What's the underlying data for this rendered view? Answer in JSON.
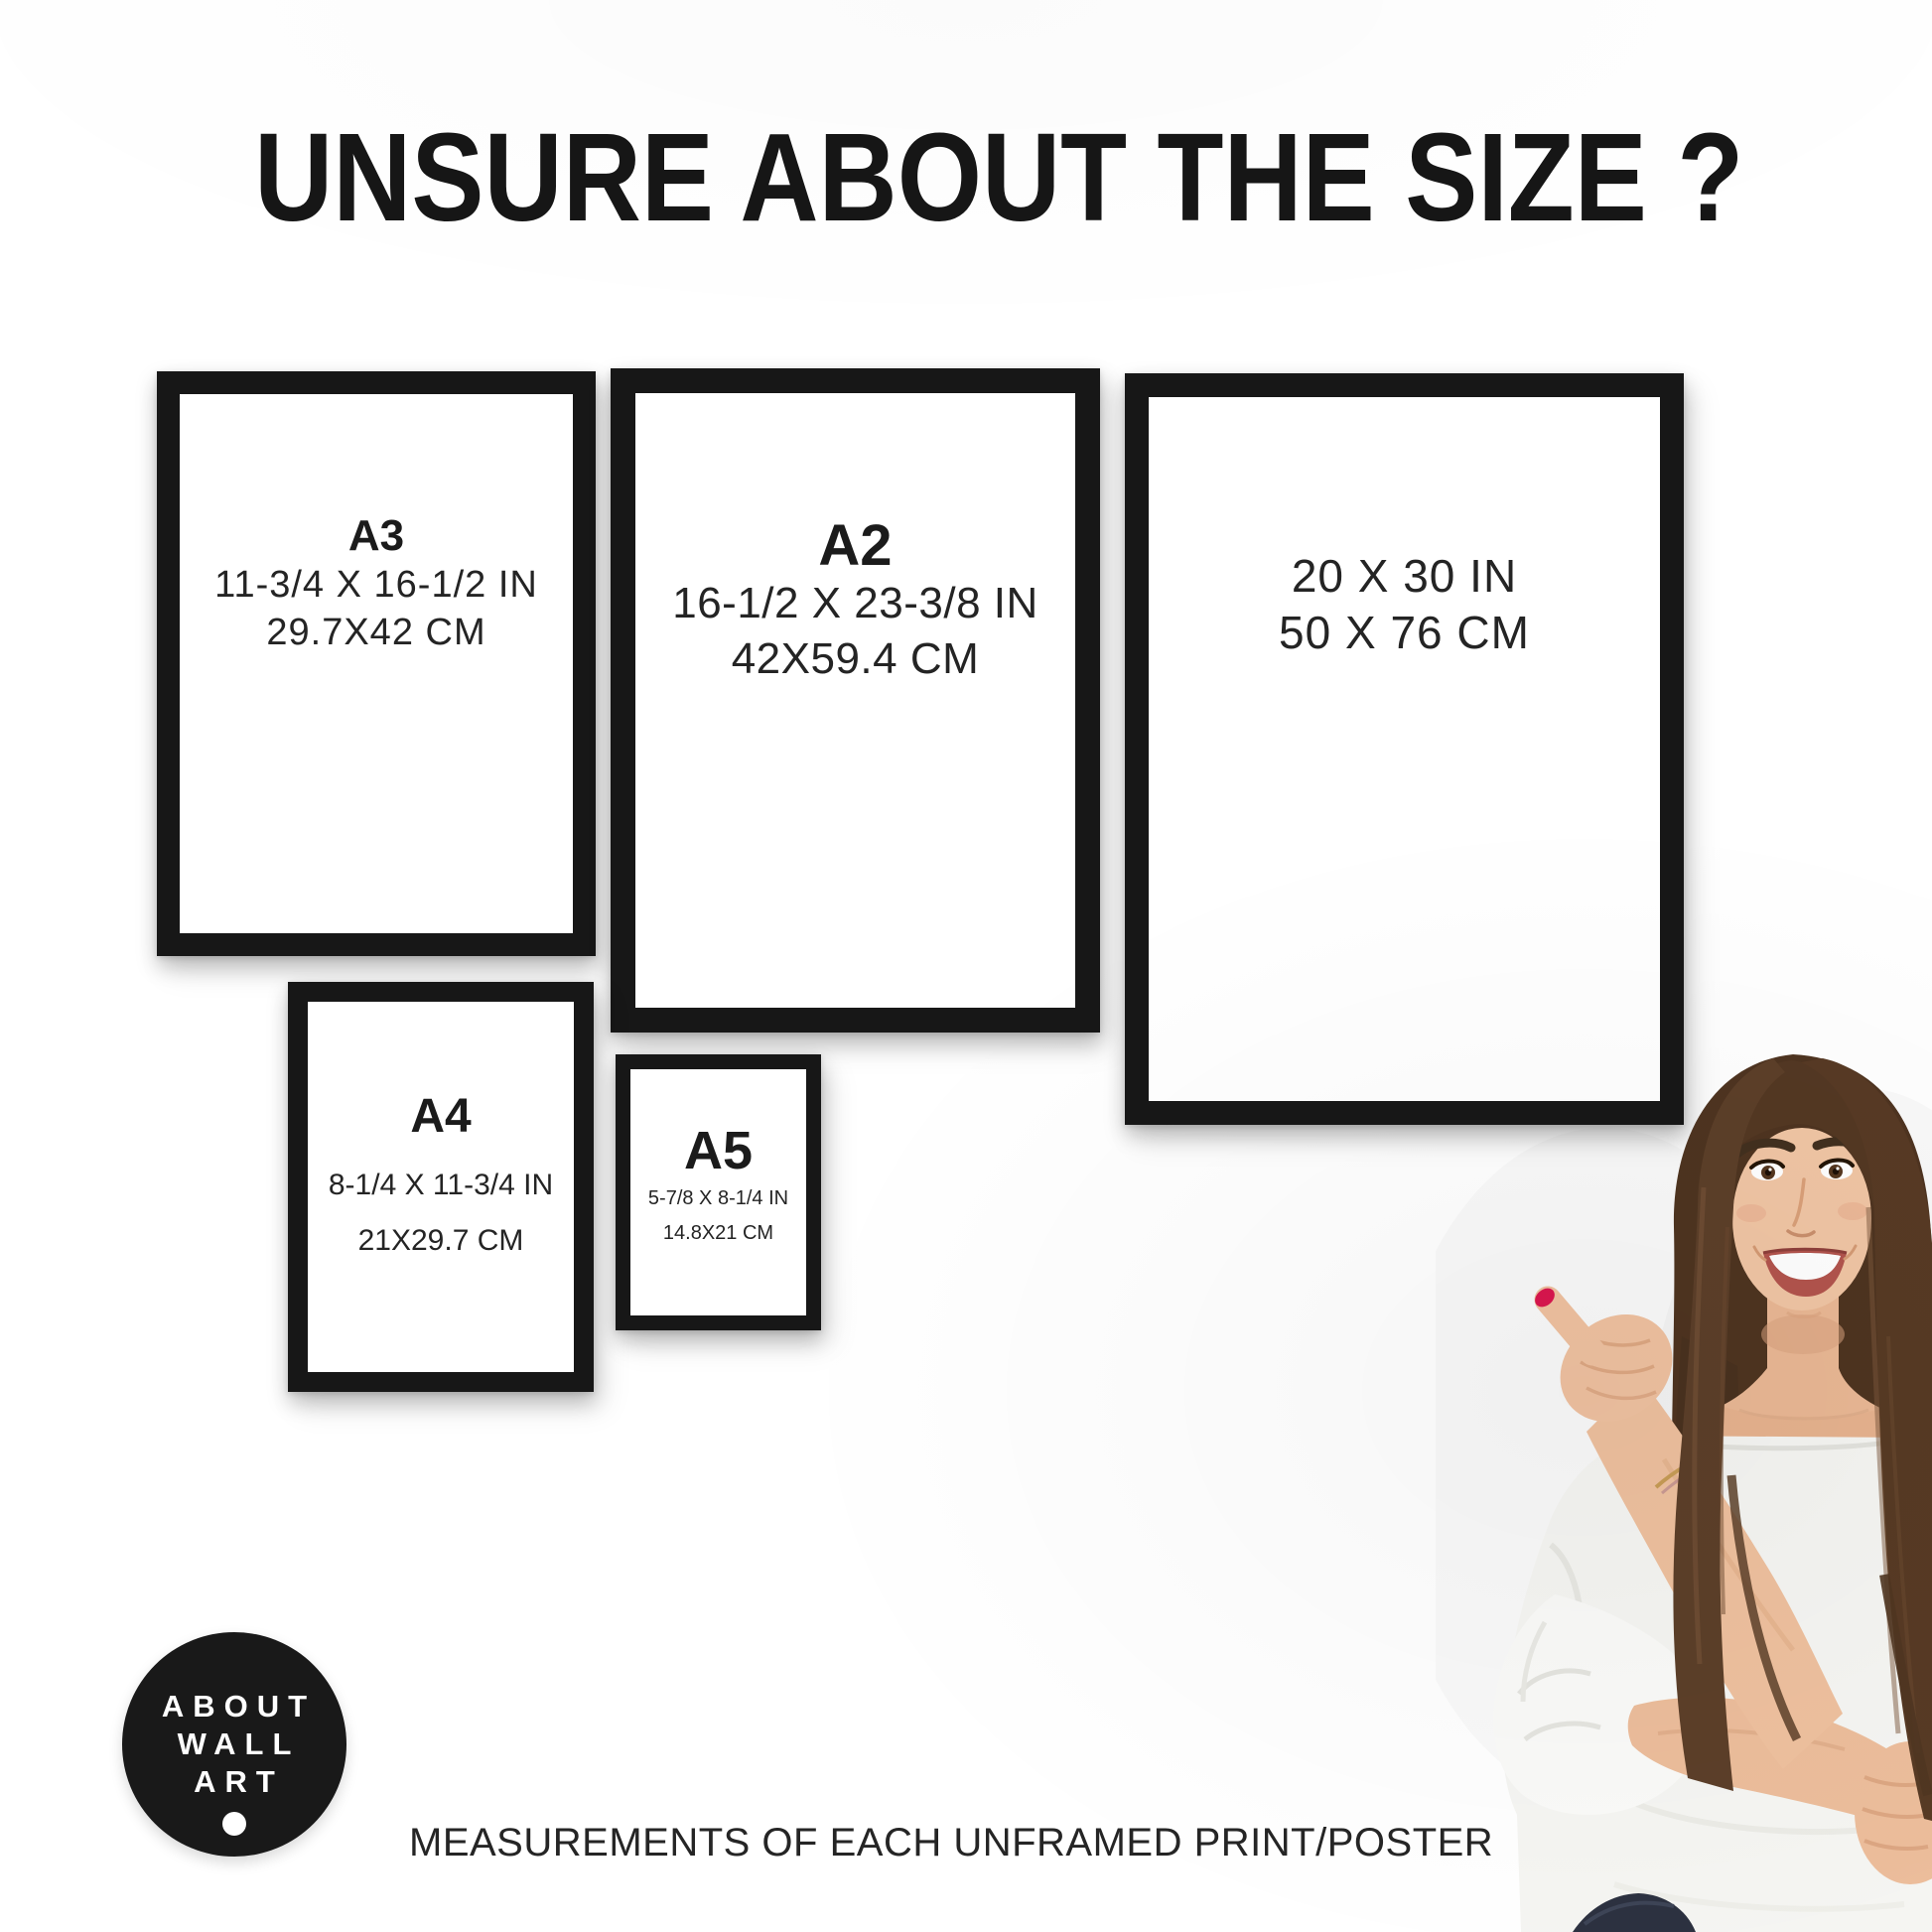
{
  "title": "UNSURE ABOUT THE SIZE ?",
  "frames": {
    "a3": {
      "label": "A3",
      "size_in": "11-3/4 X 16-1/2 IN",
      "size_cm": "29.7X42 CM"
    },
    "a2": {
      "label": "A2",
      "size_in": "16-1/2 X 23-3/8 IN",
      "size_cm": "42X59.4 CM"
    },
    "poster": {
      "size_in": "20 X 30 IN",
      "size_cm": "50 X 76 CM"
    },
    "a4": {
      "label": "A4",
      "size_in": "8-1/4 X 11-3/4 IN",
      "size_cm": "21X29.7 CM"
    },
    "a5": {
      "label": "A5",
      "size_in": "5-7/8 X 8-1/4 IN",
      "size_cm": "14.8X21 CM"
    }
  },
  "logo": {
    "line1": "ABOUT",
    "line2": "WALL",
    "line3": "ART"
  },
  "caption": "MEASUREMENTS OF EACH UNFRAMED PRINT/POSTER",
  "colors": {
    "frame_border": "#171717",
    "background": "#ffffff",
    "text": "#1e1e1e",
    "logo_background": "#191919",
    "logo_text": "#ffffff",
    "nail_accent": "#d9164e"
  }
}
